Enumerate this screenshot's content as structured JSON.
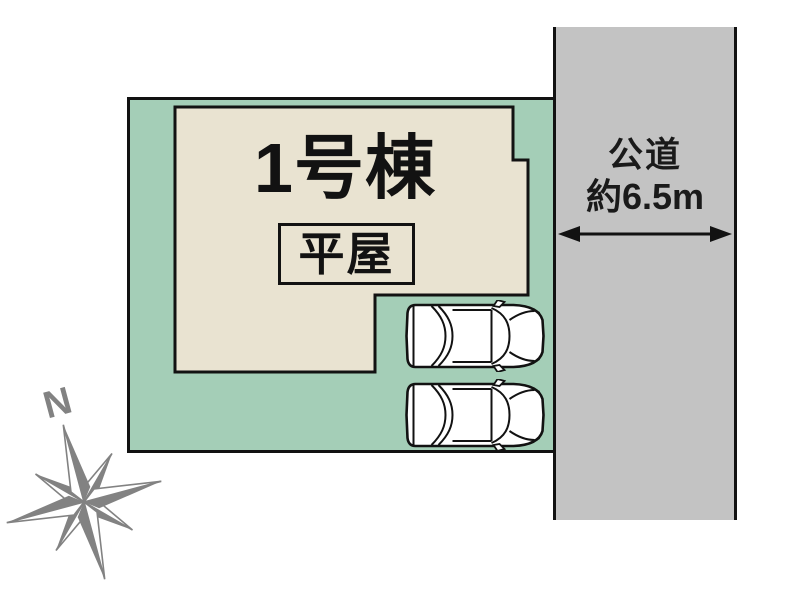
{
  "building": {
    "name": "1号棟",
    "type": "平屋"
  },
  "road": {
    "name": "公道",
    "width": "約6.5m"
  },
  "compass": {
    "north": "N"
  },
  "colors": {
    "plot_green": "#a4ceb7",
    "building_beige": "#e9e3d1",
    "road_gray": "#c3c3c3",
    "line_black": "#121212",
    "compass_gray": "#828282"
  }
}
